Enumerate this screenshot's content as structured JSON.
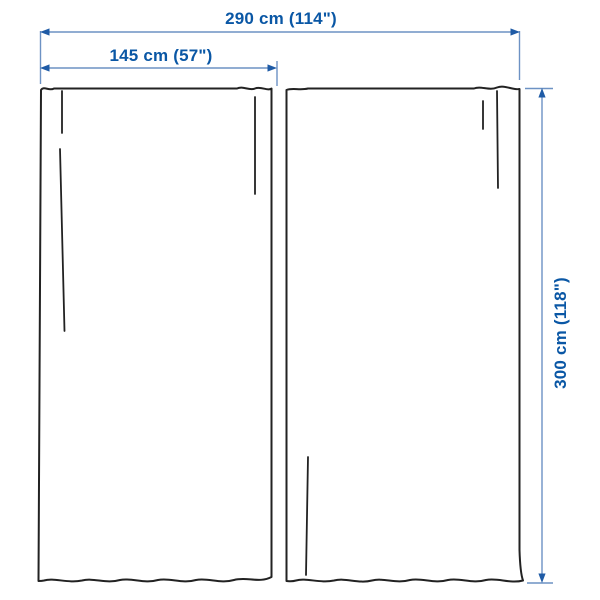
{
  "diagram": {
    "dimensions": {
      "total_width": "290 cm (114\")",
      "panel_width": "145 cm (57\")",
      "height": "300 cm (118\")"
    },
    "colors": {
      "background": "#ffffff",
      "dimension_text": "#0a57a5",
      "dimension_line": "#6d92c4",
      "arrowhead": "#1f5ba6",
      "curtain_outline": "#222222"
    }
  }
}
